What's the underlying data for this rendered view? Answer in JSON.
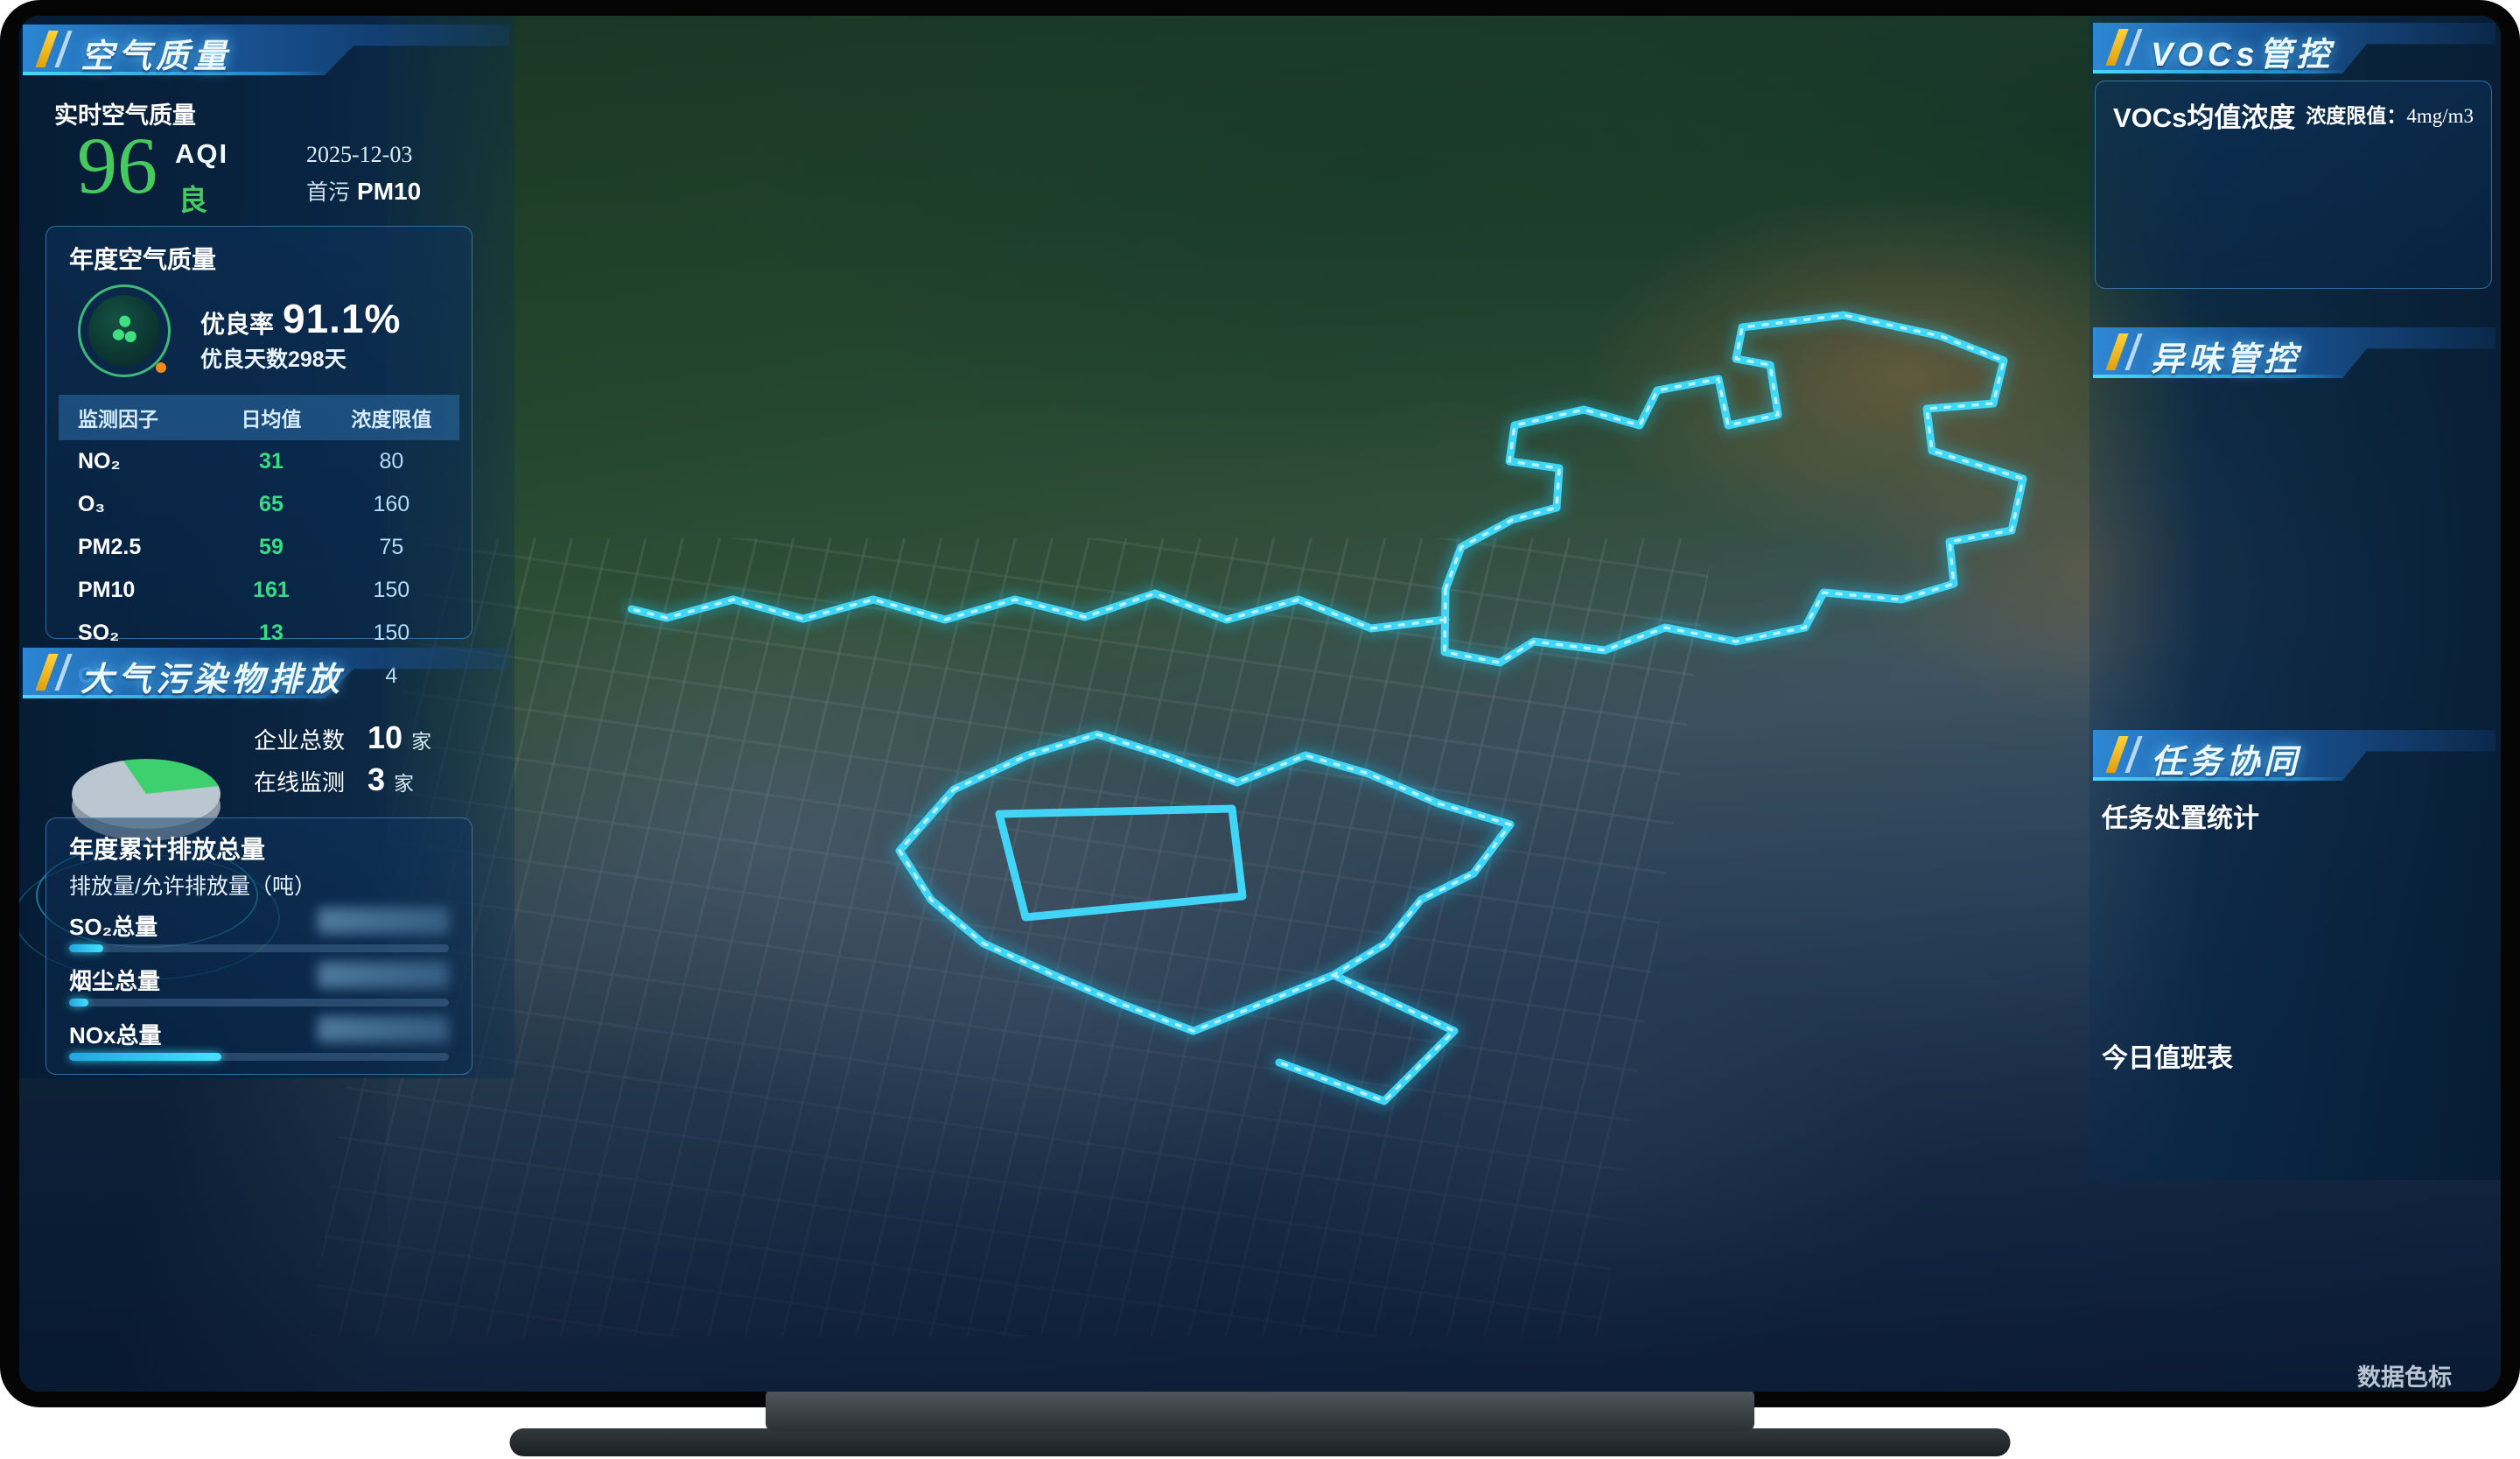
{
  "left": {
    "air": {
      "title": "空气质量",
      "realtime_label": "实时空气质量",
      "aqi_value": "96",
      "aqi_label": "AQI",
      "aqi_level": "良",
      "date": "2025-12-03",
      "primary_label": "首污",
      "primary_value": "PM10",
      "annual": {
        "title": "年度空气质量",
        "good_rate_label": "优良率",
        "good_rate": "91.1%",
        "good_days": "优良天数298天",
        "table_headers": [
          "监测因子",
          "日均值",
          "浓度限值"
        ],
        "table_rows": [
          {
            "factor": "NO₂",
            "avg": "31",
            "limit": "80"
          },
          {
            "factor": "O₃",
            "avg": "65",
            "limit": "160"
          },
          {
            "factor": "PM2.5",
            "avg": "59",
            "limit": "75"
          },
          {
            "factor": "PM10",
            "avg": "161",
            "limit": "150"
          },
          {
            "factor": "SO₂",
            "avg": "13",
            "limit": "150"
          },
          {
            "factor": "CO",
            "avg": "0.6",
            "limit": "4"
          }
        ]
      }
    },
    "emissions": {
      "title": "大气污染物排放",
      "companies": {
        "total_label": "企业总数",
        "total": "10",
        "total_unit": "家",
        "online_label": "在线监测",
        "online": "3",
        "online_unit": "家"
      },
      "pie_online_pct": 26,
      "annual": {
        "title": "年度累计排放总量",
        "subtitle": "排放量/允许排放量（吨）",
        "bars": [
          {
            "label": "SO₂总量",
            "pct": 9,
            "value_redacted": true
          },
          {
            "label": "烟尘总量",
            "pct": 5,
            "value_redacted": true
          },
          {
            "label": "NOx总量",
            "pct": 40,
            "value_redacted": true
          }
        ]
      }
    }
  },
  "right": {
    "vocs": {
      "title": "VOCs管控",
      "card_title": "VOCs均值浓度",
      "limit_label": "浓度限值：",
      "limit_value": "4mg/m3",
      "years": [
        {
          "year": "2024年",
          "value": "0.79",
          "unit": "mg/m³"
        },
        {
          "year": "2025年",
          "value": "0.56",
          "unit": "mg/m³"
        }
      ],
      "dots": [
        true,
        false
      ]
    },
    "odor": {
      "title": "异味管控",
      "stations": [
        {
          "name": "CJ-7(A区兴福东北厂...",
          "time": "2025-12-03 08时",
          "metrics": [
            {
              "name": "臭气浓度",
              "value": "5.0",
              "limit": "20"
            },
            {
              "name": "三甲胺",
              "value": "0.005",
              "limit": "0.08"
            },
            {
              "name": "H₂S",
              "value": "0.011",
              "limit": "0.01"
            }
          ]
        },
        {
          "name": "CJ-8(A区兴瑞烧碱...",
          "time": "2025-12-03 08时",
          "metrics": [
            {
              "name": "臭气浓度",
              "value": "4.0",
              "limit": "20"
            },
            {
              "name": "H₂S",
              "value": "0.004",
              "limit": "0.06"
            },
            {
              "name": "NH₃",
              "value": "0.021",
              "limit": "0.2"
            }
          ]
        },
        {
          "name": "CJ-9(A区泰盛西部...",
          "time": "2025-12-03 08时",
          "metrics": [
            {
              "name": "臭气浓度",
              "value": "4.0",
              "limit": "20"
            },
            {
              "name": "H₂S",
              "value": "0.004",
              "limit": "0.06"
            },
            {
              "name": "NH₃",
              "value": "0.022",
              "limit": "0.2"
            }
          ]
        }
      ],
      "dots": [
        false,
        false,
        true,
        false,
        false
      ]
    },
    "tasks": {
      "title": "任务协同",
      "stats_label": "任务处置统计",
      "legend": [
        {
          "label": "已处置",
          "color": "#2fca6e"
        },
        {
          "label": "处置中",
          "color": "#f0a818"
        }
      ],
      "gauges": [
        {
          "done": "0",
          "total": "0",
          "label": "大气环境"
        },
        {
          "done": "0",
          "total": "0",
          "label": "企业环境"
        }
      ],
      "duty_title": "今日值班表",
      "duty_cards": [
        {
          "role": "值班领导",
          "name_redacted": true
        },
        {
          "role": "值班调度",
          "name_redacted": true
        }
      ]
    }
  },
  "map": {
    "search_tools": [
      {
        "icon": "search-icon"
      },
      {
        "icon": "globe-icon"
      }
    ],
    "markers": [
      {
        "type": "elbow",
        "x": 56.0,
        "y": 32.9,
        "label": "雨虹兴发"
      },
      {
        "type": "doc",
        "x": 68.3,
        "y": 32.6,
        "label": "兴拓新材料"
      },
      {
        "type": "elbow",
        "x": 60.6,
        "y": 36.8
      },
      {
        "type": "grid",
        "x": 76.6,
        "y": 36.6
      },
      {
        "type": "elbow",
        "x": 78.8,
        "y": 35.7
      },
      {
        "type": "doc",
        "x": 54.0,
        "y": 43.9,
        "label": "兴发环保科技"
      },
      {
        "type": "elbow",
        "x": 61.1,
        "y": 42.3,
        "label": "兴力电子材料"
      },
      {
        "type": "diamond",
        "x": 41.2,
        "y": 44.2
      },
      {
        "type": "leaf",
        "x": 41.8,
        "y": 46.2
      },
      {
        "type": "elbow2",
        "x": 40.8,
        "y": 47.7
      },
      {
        "type": "elbow",
        "x": 47.4,
        "y": 44.7
      },
      {
        "type": "elbow",
        "x": 33.6,
        "y": 51.1,
        "label": "兴瑞硅材料"
      },
      {
        "type": "elbow",
        "x": 34.3,
        "y": 54.6
      },
      {
        "type": "elbow",
        "x": 42.2,
        "y": 51.4
      },
      {
        "type": "elbow",
        "x": 25.2,
        "y": 40.8
      },
      {
        "type": "grid",
        "x": 26.9,
        "y": 41.3
      },
      {
        "type": "pin",
        "x": 25.3,
        "y": 43.3
      },
      {
        "type": "elbow",
        "x": 36.3,
        "y": 41.6
      },
      {
        "type": "pin",
        "x": 36.3,
        "y": 43.9
      },
      {
        "type": "factory",
        "x": 34.8,
        "y": 58.4
      },
      {
        "type": "factory",
        "x": 42.4,
        "y": 58.3
      },
      {
        "type": "doc",
        "x": 44.8,
        "y": 58.5,
        "label": "磷化工研究院"
      },
      {
        "type": "doc",
        "x": 48.4,
        "y": 60.2,
        "label": "苏鹏科技"
      },
      {
        "type": "doc",
        "x": 45.9,
        "y": 63.3,
        "label": "汇富纳米材料"
      },
      {
        "type": "elbow",
        "x": 26.4,
        "y": 58.7
      },
      {
        "type": "elbow",
        "x": 29.0,
        "y": 59.6
      },
      {
        "type": "pin",
        "x": 22.3,
        "y": 56.8
      },
      {
        "type": "grid",
        "x": 74.5,
        "y": 58.4
      },
      {
        "type": "pin",
        "x": 48.2,
        "y": 67.4
      },
      {
        "type": "elbow",
        "x": 30.9,
        "y": 48.5
      }
    ],
    "chips": [
      {
        "text": "兴瑞D区1号",
        "x": 38.4,
        "y": 44.3
      },
      {
        "text": "泰盛化工",
        "x": 43.9,
        "y": 44.3
      },
      {
        "text": "兴福电子材料",
        "x": 36.6,
        "y": 61.0
      }
    ],
    "controls": [
      {
        "icon": "layers-icon"
      },
      {
        "icon": "compass-icon"
      },
      {
        "icon": "2d-icon",
        "text": "2D"
      },
      {
        "icon": "fullscreen-icon"
      }
    ],
    "legend": {
      "label": "数据色标",
      "items": [
        {
          "text": "正常",
          "color": "#35e086"
        },
        {
          "text": "异常",
          "color": "#ff6452"
        },
        {
          "text": "离线",
          "color": "#a8b8c6"
        }
      ]
    }
  }
}
